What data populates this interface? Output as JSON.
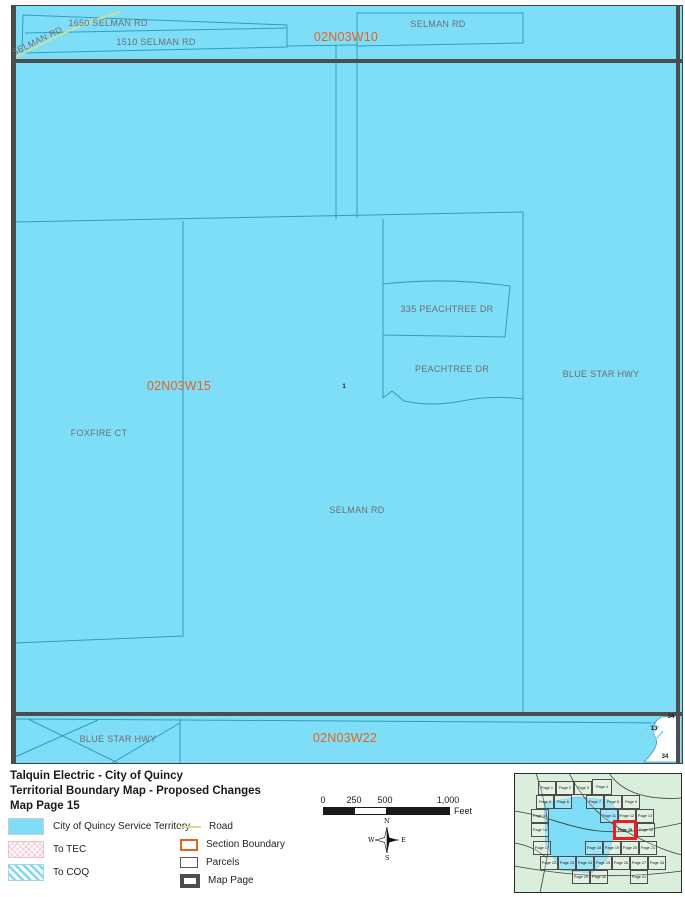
{
  "title": {
    "line1": "Talquin Electric - City of Quincy",
    "line2": "Territorial Boundary Map - Proposed Changes",
    "line3": "Map Page 15"
  },
  "colors": {
    "service_territory": "#7fdef7",
    "parcel_line": "#2e9ec0",
    "section_label": "#e8611c",
    "map_page_line": "#4d4d4d",
    "road_line": "#c9e19b",
    "highlight_red": "#ed1c24",
    "tec_hatch_pink": "#f6c9d2",
    "coq_hatch_blue": "#7fd6f2"
  },
  "map": {
    "labels": [
      {
        "name": "road-label-selman-rd-diagonal",
        "text": "SELMAN RD",
        "x": 37,
        "y": 41,
        "rotate": -26,
        "type": "road"
      },
      {
        "name": "parcel-label-1650-selman-rd",
        "text": "1650 SELMAN RD",
        "x": 108,
        "y": 23,
        "type": "road"
      },
      {
        "name": "parcel-label-1510-selman-rd",
        "text": "1510 SELMAN RD",
        "x": 156,
        "y": 42,
        "type": "road"
      },
      {
        "name": "road-label-selman-rd-topright",
        "text": "SELMAN RD",
        "x": 438,
        "y": 24,
        "type": "road"
      },
      {
        "name": "section-label-02n03w10",
        "text": "02N03W10",
        "x": 346,
        "y": 37,
        "type": "section"
      },
      {
        "name": "section-label-02n03w15",
        "text": "02N03W15",
        "x": 179,
        "y": 386,
        "type": "section"
      },
      {
        "name": "section-label-02n03w22",
        "text": "02N03W22",
        "x": 345,
        "y": 738,
        "type": "section"
      },
      {
        "name": "parcel-label-335-peachtree-dr",
        "text": "335 PEACHTREE DR",
        "x": 447,
        "y": 309,
        "type": "road"
      },
      {
        "name": "road-label-peachtree-dr",
        "text": "PEACHTREE DR",
        "x": 452,
        "y": 369,
        "type": "road"
      },
      {
        "name": "road-label-blue-star-hwy-east",
        "text": "BLUE STAR HWY",
        "x": 601,
        "y": 374,
        "type": "road"
      },
      {
        "name": "road-label-foxfire-ct",
        "text": "FOXFIRE CT",
        "x": 99,
        "y": 433,
        "type": "road"
      },
      {
        "name": "road-label-selman-rd-center",
        "text": "SELMAN RD",
        "x": 357,
        "y": 510,
        "type": "road"
      },
      {
        "name": "road-label-blue-star-hwy-south",
        "text": "BLUE STAR HWY",
        "x": 118,
        "y": 739,
        "type": "road"
      },
      {
        "name": "small-label-1",
        "text": "1",
        "x": 344,
        "y": 387,
        "type": "small"
      },
      {
        "name": "small-label-34-top",
        "text": "34",
        "x": 671,
        "y": 717,
        "type": "small"
      },
      {
        "name": "small-label-13",
        "text": "13",
        "x": 654,
        "y": 729,
        "type": "small"
      },
      {
        "name": "small-label-34-bottom",
        "text": "34",
        "x": 665,
        "y": 757,
        "type": "small"
      }
    ]
  },
  "legend": {
    "items_left": [
      {
        "label": "City of Quincy Service Territory",
        "swatch": "territory",
        "name": "legend-item-city-of-quincy-service-territory"
      },
      {
        "label": "To TEC",
        "swatch": "tec",
        "name": "legend-item-to-tec"
      },
      {
        "label": "To COQ",
        "swatch": "coq",
        "name": "legend-item-to-coq"
      }
    ],
    "items_right": [
      {
        "label": "Road",
        "swatch": "road",
        "name": "legend-item-road"
      },
      {
        "label": "Section Boundary",
        "swatch": "section",
        "name": "legend-item-section-boundary"
      },
      {
        "label": "Parcels",
        "swatch": "parcels",
        "name": "legend-item-parcels"
      },
      {
        "label": "Map Page",
        "swatch": "mappage",
        "name": "legend-item-map-page"
      }
    ]
  },
  "scalebar": {
    "ticks": [
      {
        "label": "0",
        "pos": 0
      },
      {
        "label": "250",
        "pos": 31
      },
      {
        "label": "500",
        "pos": 62
      },
      {
        "label": "1,000",
        "pos": 125
      }
    ],
    "segments": [
      {
        "pos": 0,
        "w": 31,
        "fill": "#1a1a1a"
      },
      {
        "pos": 31,
        "w": 31,
        "fill": "#ffffff"
      },
      {
        "pos": 62,
        "w": 63,
        "fill": "#1a1a1a"
      }
    ],
    "unit": "Feet"
  },
  "compass": {
    "n": "N",
    "s": "S",
    "e": "E",
    "w": "W"
  },
  "inset": {
    "highlighted_page": "Page 15",
    "pages": [
      {
        "label": "Page 1",
        "x": 24,
        "y": 8,
        "w": 18,
        "h": 14
      },
      {
        "label": "Page 2",
        "x": 42,
        "y": 8,
        "w": 18,
        "h": 14
      },
      {
        "label": "Page 3",
        "x": 60,
        "y": 8,
        "w": 18,
        "h": 14
      },
      {
        "label": "Page 4",
        "x": 78,
        "y": 6,
        "w": 20,
        "h": 16
      },
      {
        "label": "Page 5",
        "x": 22,
        "y": 22,
        "w": 18,
        "h": 14
      },
      {
        "label": "Page 6",
        "x": 40,
        "y": 22,
        "w": 18,
        "h": 14
      },
      {
        "label": "Page 7",
        "x": 72,
        "y": 22,
        "w": 18,
        "h": 14
      },
      {
        "label": "Page 8",
        "x": 90,
        "y": 22,
        "w": 18,
        "h": 14
      },
      {
        "label": "Page 9",
        "x": 108,
        "y": 22,
        "w": 18,
        "h": 14
      },
      {
        "label": "Page 10",
        "x": 17,
        "y": 36,
        "w": 18,
        "h": 14
      },
      {
        "label": "Page 11",
        "x": 86,
        "y": 36,
        "w": 18,
        "h": 14
      },
      {
        "label": "Page 12",
        "x": 104,
        "y": 36,
        "w": 18,
        "h": 14
      },
      {
        "label": "Page 13",
        "x": 122,
        "y": 36,
        "w": 18,
        "h": 14
      },
      {
        "label": "Page 14",
        "x": 17,
        "y": 50,
        "w": 18,
        "h": 14
      },
      {
        "label": "Page 15",
        "x": 99,
        "y": 47,
        "w": 24,
        "h": 20,
        "highlight": true
      },
      {
        "label": "Page 16",
        "x": 123,
        "y": 50,
        "w": 18,
        "h": 14
      },
      {
        "label": "Page 17",
        "x": 19,
        "y": 68,
        "w": 18,
        "h": 14
      },
      {
        "label": "Page 18",
        "x": 71,
        "y": 68,
        "w": 18,
        "h": 14
      },
      {
        "label": "Page 19",
        "x": 89,
        "y": 68,
        "w": 18,
        "h": 14
      },
      {
        "label": "Page 20",
        "x": 107,
        "y": 68,
        "w": 18,
        "h": 14
      },
      {
        "label": "Page 21",
        "x": 125,
        "y": 68,
        "w": 18,
        "h": 14
      },
      {
        "label": "Page 22",
        "x": 26,
        "y": 83,
        "w": 18,
        "h": 14
      },
      {
        "label": "Page 23",
        "x": 44,
        "y": 83,
        "w": 18,
        "h": 14
      },
      {
        "label": "Page 24",
        "x": 62,
        "y": 83,
        "w": 18,
        "h": 14
      },
      {
        "label": "Page 25",
        "x": 80,
        "y": 83,
        "w": 18,
        "h": 14
      },
      {
        "label": "Page 26",
        "x": 98,
        "y": 83,
        "w": 18,
        "h": 14
      },
      {
        "label": "Page 27",
        "x": 116,
        "y": 83,
        "w": 18,
        "h": 14
      },
      {
        "label": "Page 28",
        "x": 134,
        "y": 83,
        "w": 18,
        "h": 14
      },
      {
        "label": "Page 29",
        "x": 58,
        "y": 97,
        "w": 18,
        "h": 14
      },
      {
        "label": "Page 30",
        "x": 76,
        "y": 97,
        "w": 18,
        "h": 14
      },
      {
        "label": "Page 31",
        "x": 116,
        "y": 97,
        "w": 18,
        "h": 14
      }
    ]
  }
}
